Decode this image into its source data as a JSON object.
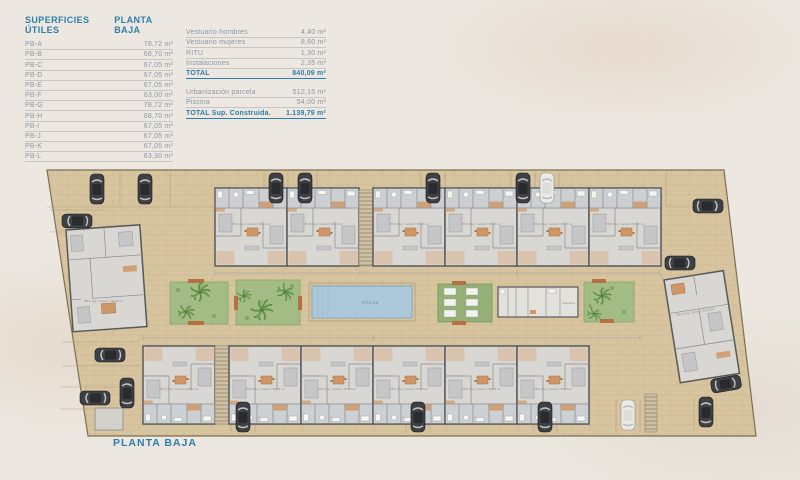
{
  "colors": {
    "accent_teal": "#2e7ea6",
    "pavement_tan": "#d7c5a0",
    "building_gray": "#d8d7d3",
    "garden_green": "#a3bc85",
    "pool_blue": "#abc8da",
    "accent_orange": "#cf9768",
    "car_dark": "#3f4044"
  },
  "surfaces_table": {
    "title_col1": "SUPERFICIES ÚTILES",
    "title_col2": "PLANTA BAJA",
    "rows": [
      {
        "label": "PB-A",
        "value": "78,72 m²"
      },
      {
        "label": "PB-B",
        "value": "68,70 m²"
      },
      {
        "label": "PB-C",
        "value": "67,05 m²"
      },
      {
        "label": "PB-D",
        "value": "67,05 m²"
      },
      {
        "label": "PB-E",
        "value": "67,05 m²"
      },
      {
        "label": "PB-F",
        "value": "63,00 m²"
      },
      {
        "label": "PB-G",
        "value": "78,72 m²"
      },
      {
        "label": "PB-H",
        "value": "68,70 m²"
      },
      {
        "label": "PB-I",
        "value": "67,05 m²"
      },
      {
        "label": "PB-J",
        "value": "67,05 m²"
      },
      {
        "label": "PB-K",
        "value": "67,05 m²"
      },
      {
        "label": "PB-L",
        "value": "63,30 m²"
      }
    ]
  },
  "summary_table": {
    "rows": [
      {
        "label": "Vestuario hombres",
        "value": "4,40 m²"
      },
      {
        "label": "Vestuario mujeres",
        "value": "8,60 m²"
      },
      {
        "label": "RITU",
        "value": "1,30 m²"
      },
      {
        "label": "Instalaciones",
        "value": "2,35 m²"
      }
    ],
    "total": {
      "label": "TOTAL",
      "value": "840,09 m²"
    },
    "rows2": [
      {
        "label": "Urbanización parcela",
        "value": "512,15 m²"
      },
      {
        "label": "Piscina",
        "value": "54,00 m²"
      }
    ],
    "total2": {
      "label": "TOTAL Sup. Construida.",
      "value": "1.139,79 m²"
    }
  },
  "plan": {
    "pool_label": "Piscina",
    "vestuarios_label": "Vestuarios",
    "left_building_label": "PB-A Sup. Constr.= 98,03 m²",
    "right_building_label": "PB-G Sup. Constr.= 92,03 m²",
    "top_units": [
      {
        "label": "PB-A Sup. Constr.= 98,14 m²"
      },
      {
        "label": "PB-B Sup. Constr.= 95,33 m²"
      },
      {
        "label": "PB-C Sup. Constr.= 95,33 m²"
      },
      {
        "label": "PB-D Sup. Constr.= 95,33 m²"
      },
      {
        "label": "PB-E Sup. Constr.= 95,33 m²"
      },
      {
        "label": "PB-F Sup. Constr.= 95,33 m²"
      }
    ],
    "bottom_units": [
      {
        "label": "PB-G Sup. Constr.= 98,14 m²"
      },
      {
        "label": "PB-H Sup. Constr.= 95,33 m²"
      },
      {
        "label": "PB-I Sup. Constr.= 95,33 m²"
      },
      {
        "label": "PB-J Sup. Constr.= 95,33 m²"
      },
      {
        "label": "PB-K Sup. Constr.= 95,33 m²"
      },
      {
        "label": "PB-L Sup. Constr.= 95,33 m²"
      }
    ]
  },
  "footer": {
    "plan_title": "PLANTA BAJA"
  }
}
